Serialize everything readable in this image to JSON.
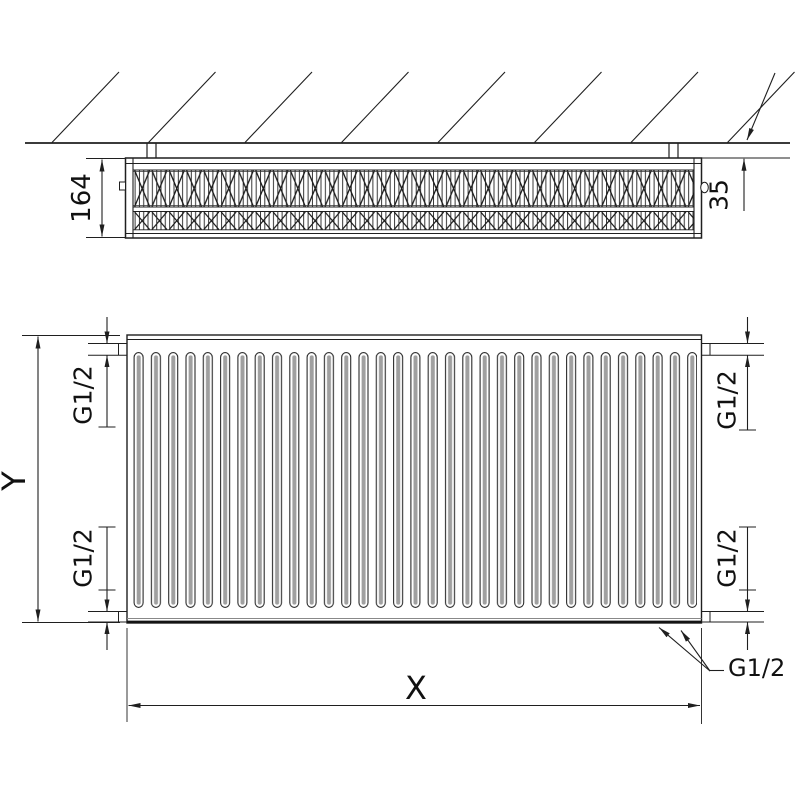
{
  "labels": {
    "depth": "164",
    "wall_clearance": "35",
    "height": "Y",
    "width": "X",
    "conn_top_left": "G1/2",
    "conn_bottom_left": "G1/2",
    "conn_top_right": "G1/2",
    "conn_bottom_right": "G1/2",
    "conn_bottom_callout": "G1/2"
  },
  "views": {
    "top_plan": {
      "fin_rows": 2,
      "hatch_line_count": 8,
      "wall_bracket_count": 2
    },
    "front_elevation": {
      "groove_count": 33,
      "connection_stub_count": 4
    }
  },
  "colors": {
    "line": "#1f1f1f",
    "groove_shading": "#a0a0a0",
    "background": "#ffffff"
  }
}
